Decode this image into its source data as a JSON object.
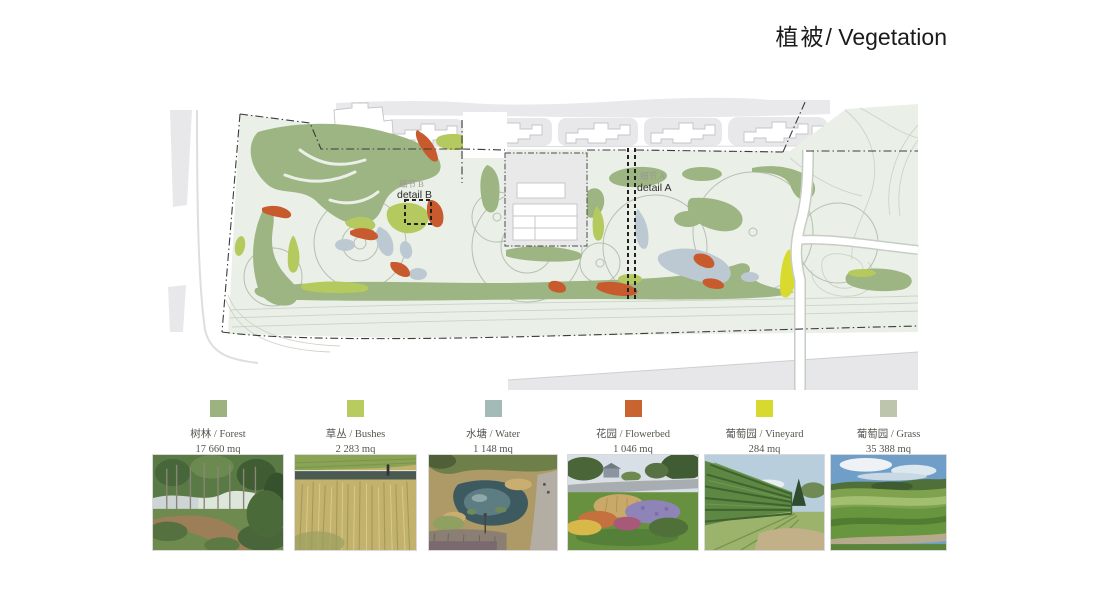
{
  "title": {
    "zh": "植被",
    "en": "/ Vegetation"
  },
  "map": {
    "detail_a_zh": "细节 A",
    "detail_a_en": "detail A",
    "detail_b_zh": "细节 B",
    "detail_b_en": "detail B",
    "palette": {
      "park_background": "#eaf0e7",
      "forest": "#9db483",
      "bushes": "#b5ca5e",
      "water": "#bdc9d2",
      "flowerbed": "#c85b2d",
      "vineyard": "#d9da2e",
      "context_grey": "#e8e8ea",
      "boundary": "#3c3c3c"
    }
  },
  "legend": {
    "items": [
      {
        "id": "forest",
        "label": "树林  / Forest",
        "area": "17 660 mq",
        "color": "#9cb381"
      },
      {
        "id": "bushes",
        "label": "草丛 / Bushes",
        "area": "2 283 mq",
        "color": "#b7cb5e"
      },
      {
        "id": "water",
        "label": "水塘 / Water",
        "area": "1 148 mq",
        "color": "#a3bab7"
      },
      {
        "id": "flowerbed",
        "label": "花园 / Flowerbed",
        "area": "1 046 mq",
        "color": "#c8642f"
      },
      {
        "id": "vineyard",
        "label": "葡萄园 / Vineyard",
        "area": "284 mq",
        "color": "#d8d92e"
      },
      {
        "id": "grass",
        "label": "葡萄园 / Grass",
        "area": "35 388 mq",
        "color": "#bec5ad"
      }
    ]
  },
  "photos": [
    {
      "id": "forest-path-photo"
    },
    {
      "id": "reed-bushes-photo"
    },
    {
      "id": "pond-water-photo"
    },
    {
      "id": "flowerbed-photo"
    },
    {
      "id": "vineyard-rows-photo"
    },
    {
      "id": "grass-hills-photo"
    }
  ]
}
